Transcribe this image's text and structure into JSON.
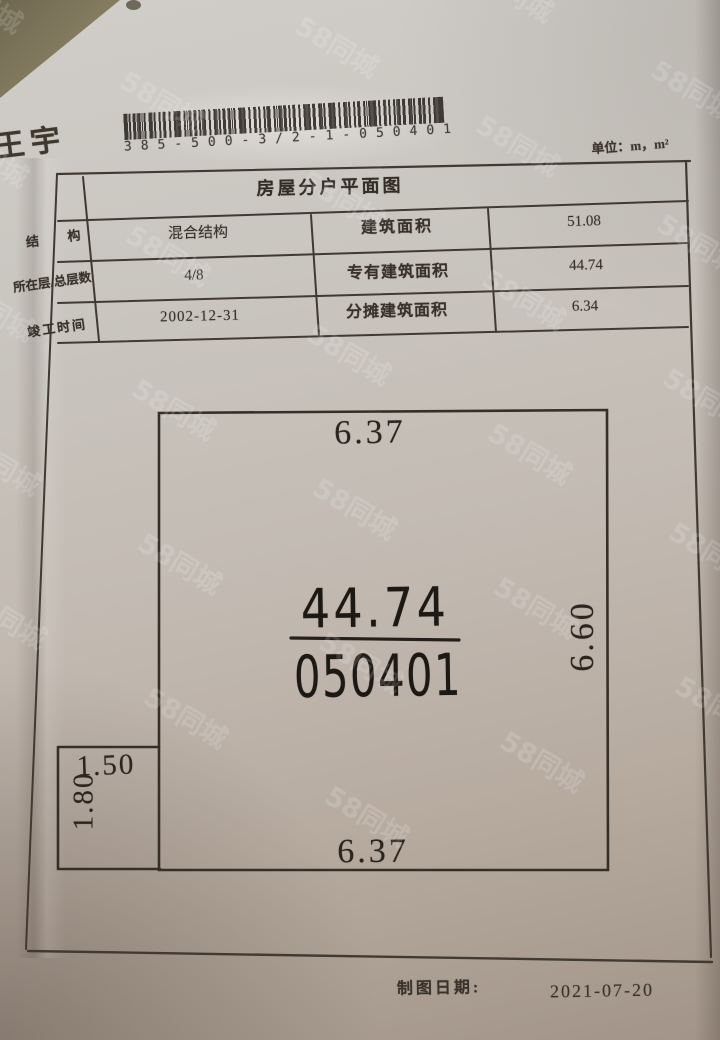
{
  "header": {
    "name": "王宇",
    "barcode_number": "385-500-3/2-1-050401",
    "unit_label": "单位：m，m²"
  },
  "document": {
    "title": "房屋分户平面图",
    "table": {
      "rows": [
        {
          "header": "结　构",
          "value": "混合结构",
          "label": "建筑面积",
          "amount": "51.08"
        },
        {
          "header": "所在层/总层数",
          "value": "4/8",
          "label": "专有建筑面积",
          "amount": "44.74"
        },
        {
          "header": "竣工时间",
          "value": "2002-12-31",
          "label": "分摊建筑面积",
          "amount": "6.34"
        }
      ]
    },
    "floorplan": {
      "dim_top": "6.37",
      "dim_right": "6.60",
      "dim_bottom": "6.37",
      "annex_width": "1.50",
      "annex_height": "1.80",
      "area": "44.74",
      "unit_number": "050401"
    },
    "footer": {
      "date_label": "制图日期:",
      "date_value": "2021-07-20"
    }
  },
  "watermark": {
    "text": "58同城"
  },
  "colors": {
    "paper": "#c6c0b8",
    "ink": "#38322b",
    "plan_ink": "#1c1814",
    "background_corner": "#6e674f"
  }
}
